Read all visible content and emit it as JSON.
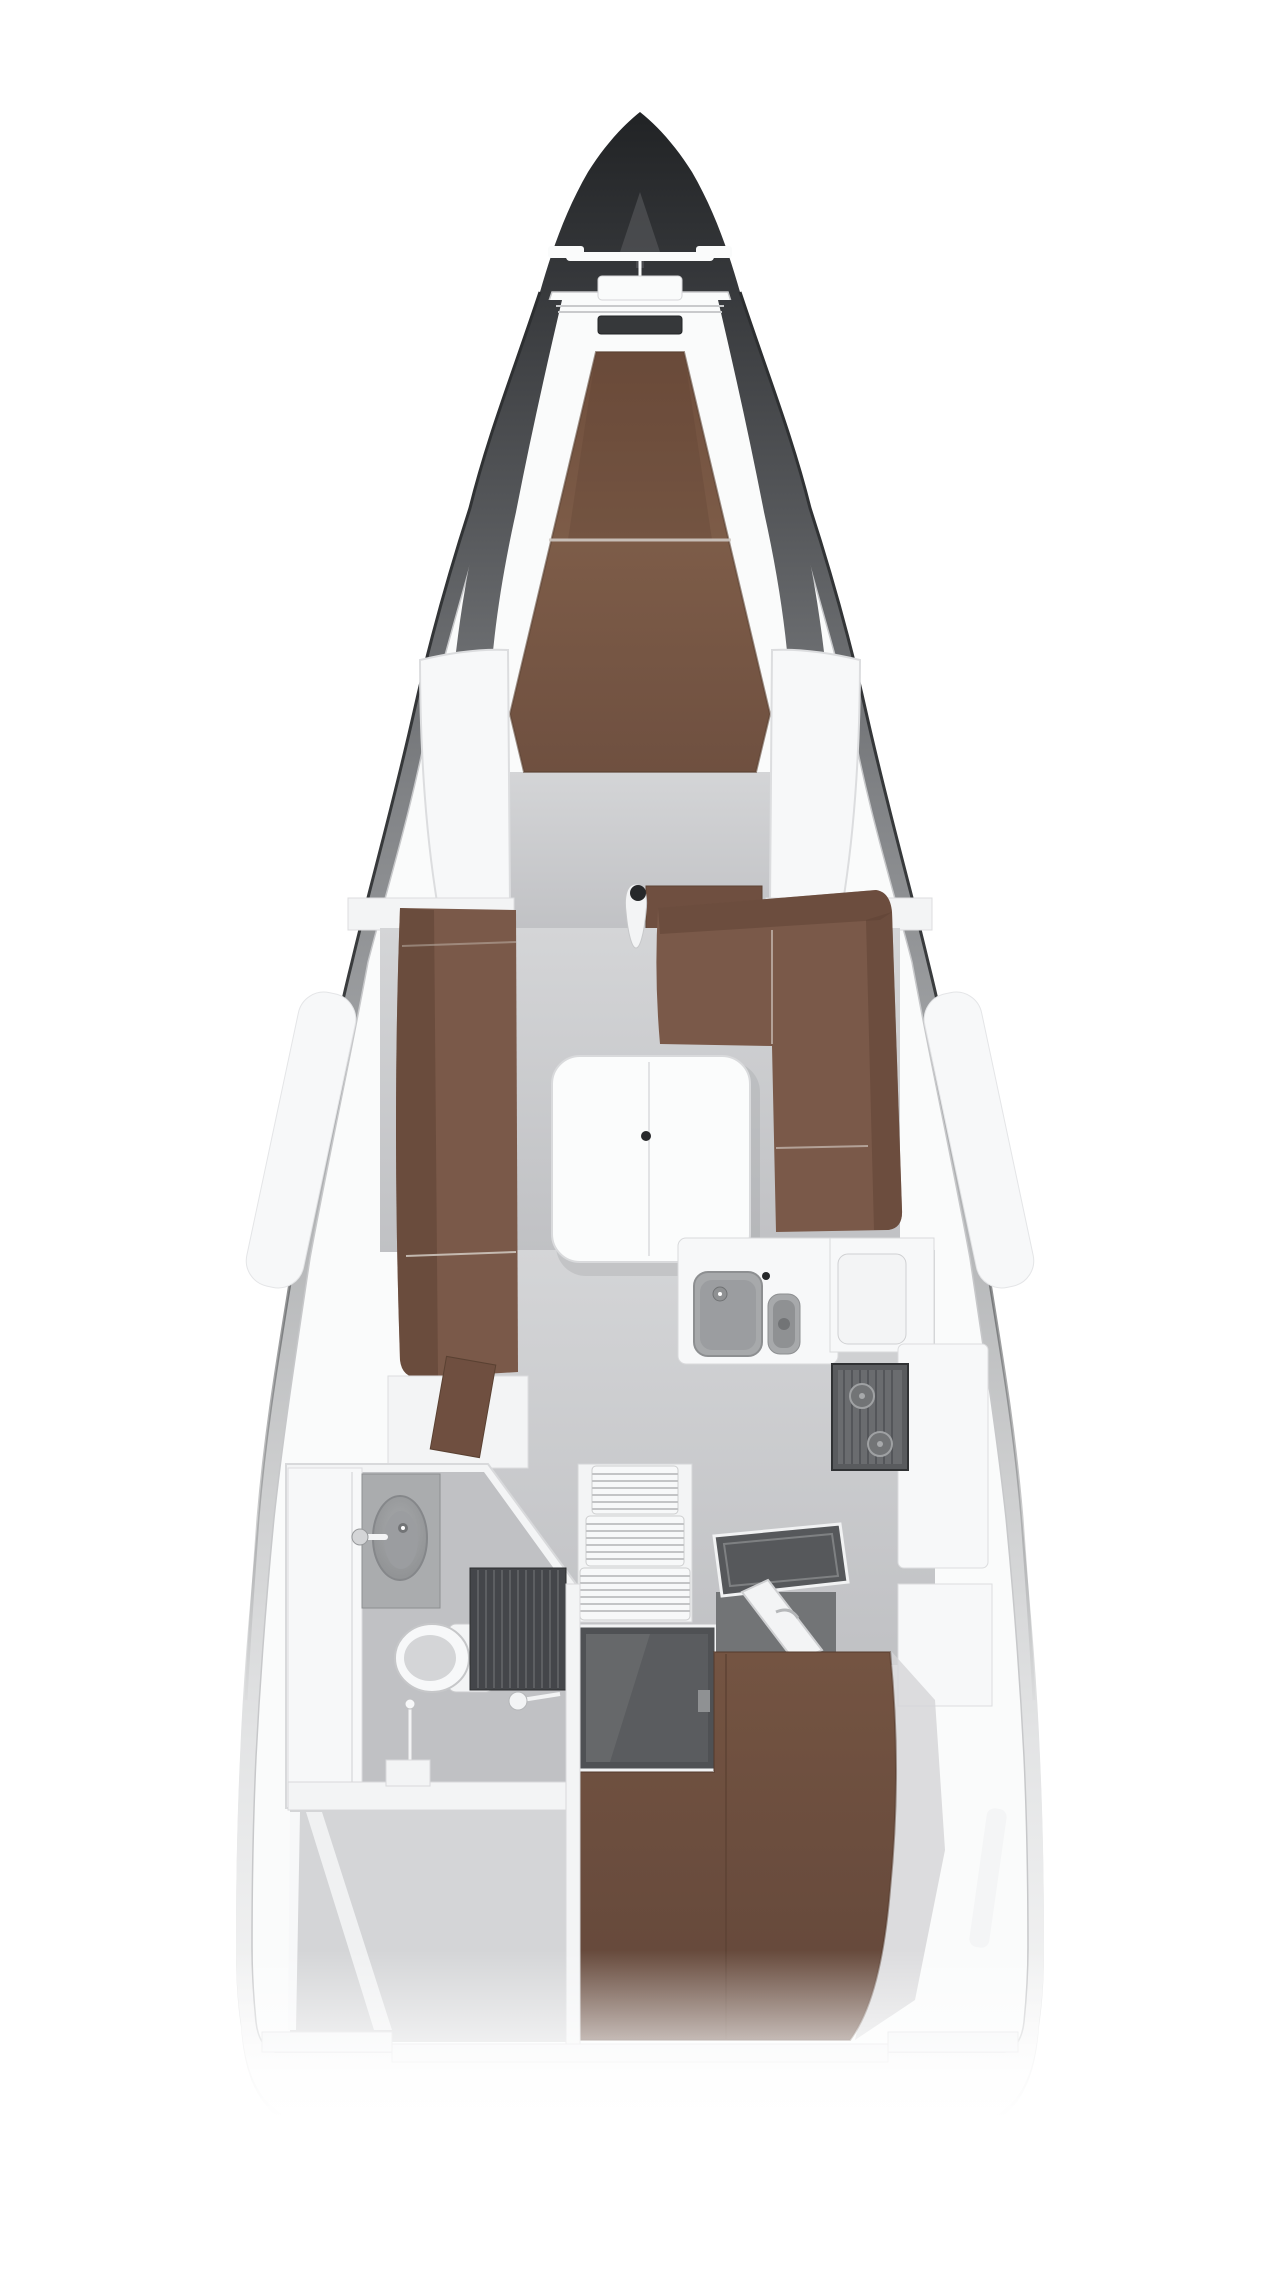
{
  "palette": {
    "page_bg": "#ffffff",
    "hull_stops": [
      "#212325",
      "#35373a",
      "#56585b",
      "#828487",
      "#aaacae",
      "#cbcccd",
      "#e3e4e5",
      "#fbfbfb"
    ],
    "deck_white": "#fafbfb",
    "wall_white": "#f3f4f5",
    "panel_white": "#f7f8f9",
    "table_white": "#fbfcfc",
    "floor_gray": "#c0c1c4",
    "floor_gray_light": "#d4d5d7",
    "floor_gray_dark": "#aaacae",
    "berth_top": "#6f4e3c",
    "berth_mid": "#7d5c48",
    "berth_low": "#6f5040",
    "aft_top": "#745442",
    "aft_low": "#63473a",
    "sofa_brown": "#7a5949",
    "sofa_dark": "#5d4233",
    "step_brown": "#6f4f40",
    "steel": "#a7a9ab",
    "steel_dark": "#8d8f91",
    "steel_deep": "#8f9193",
    "bowl_gray": "#9b9da0",
    "stove_body": "#595b5e",
    "stove_face": "#6a6c6f",
    "grate_dark": "#44464a",
    "grate_line": "#5d5f62",
    "engine_dark": "#4f5154",
    "engine_face": "#5a5c5f",
    "fixture_dark": "#36383a",
    "mast_black": "#26282a",
    "navtable_dark": "#56585b",
    "footwell_gray": "#727476",
    "shadow_soft": "#9fa2a4",
    "seam_light": "#cfc8c2"
  },
  "areas": [
    {
      "id": "anchor-windlass",
      "label": "anchor windlass"
    },
    {
      "id": "bow-hatch",
      "label": "bow deck hatch"
    },
    {
      "id": "forward-berth",
      "label": "forward cabin double berth"
    },
    {
      "id": "port-locker",
      "label": "port shelf locker"
    },
    {
      "id": "starboard-locker",
      "label": "starboard shelf locker"
    },
    {
      "id": "saloon",
      "label": "saloon"
    },
    {
      "id": "port-sofa",
      "label": "port sofa"
    },
    {
      "id": "starboard-sofa",
      "label": "starboard corner sofa"
    },
    {
      "id": "saloon-table",
      "label": "saloon folding table"
    },
    {
      "id": "mast-post",
      "label": "mast post"
    },
    {
      "id": "galley",
      "label": "galley"
    },
    {
      "id": "double-sink",
      "label": "galley double sink"
    },
    {
      "id": "stove",
      "label": "gimballed stove"
    },
    {
      "id": "fridge-lid",
      "label": "refrigerator lid"
    },
    {
      "id": "companionway",
      "label": "companionway steps"
    },
    {
      "id": "engine-hatch",
      "label": "engine compartment hatch"
    },
    {
      "id": "chart-table",
      "label": "chart table"
    },
    {
      "id": "nav-lid",
      "label": "nav locker lid"
    },
    {
      "id": "head",
      "label": "head compartment"
    },
    {
      "id": "wardrobe",
      "label": "wardrobe"
    },
    {
      "id": "washbasin",
      "label": "washbasin"
    },
    {
      "id": "toilet",
      "label": "marine toilet"
    },
    {
      "id": "shower-grate",
      "label": "shower floor grate"
    },
    {
      "id": "aft-storage",
      "label": "aft storage compartment"
    },
    {
      "id": "aft-berth",
      "label": "aft cabin double berth"
    },
    {
      "id": "hull-window-port",
      "label": "port hull window"
    },
    {
      "id": "hull-window-starboard",
      "label": "starboard hull window"
    },
    {
      "id": "hull-window-aft",
      "label": "aft hull window"
    },
    {
      "id": "transom",
      "label": "transom wall"
    }
  ]
}
